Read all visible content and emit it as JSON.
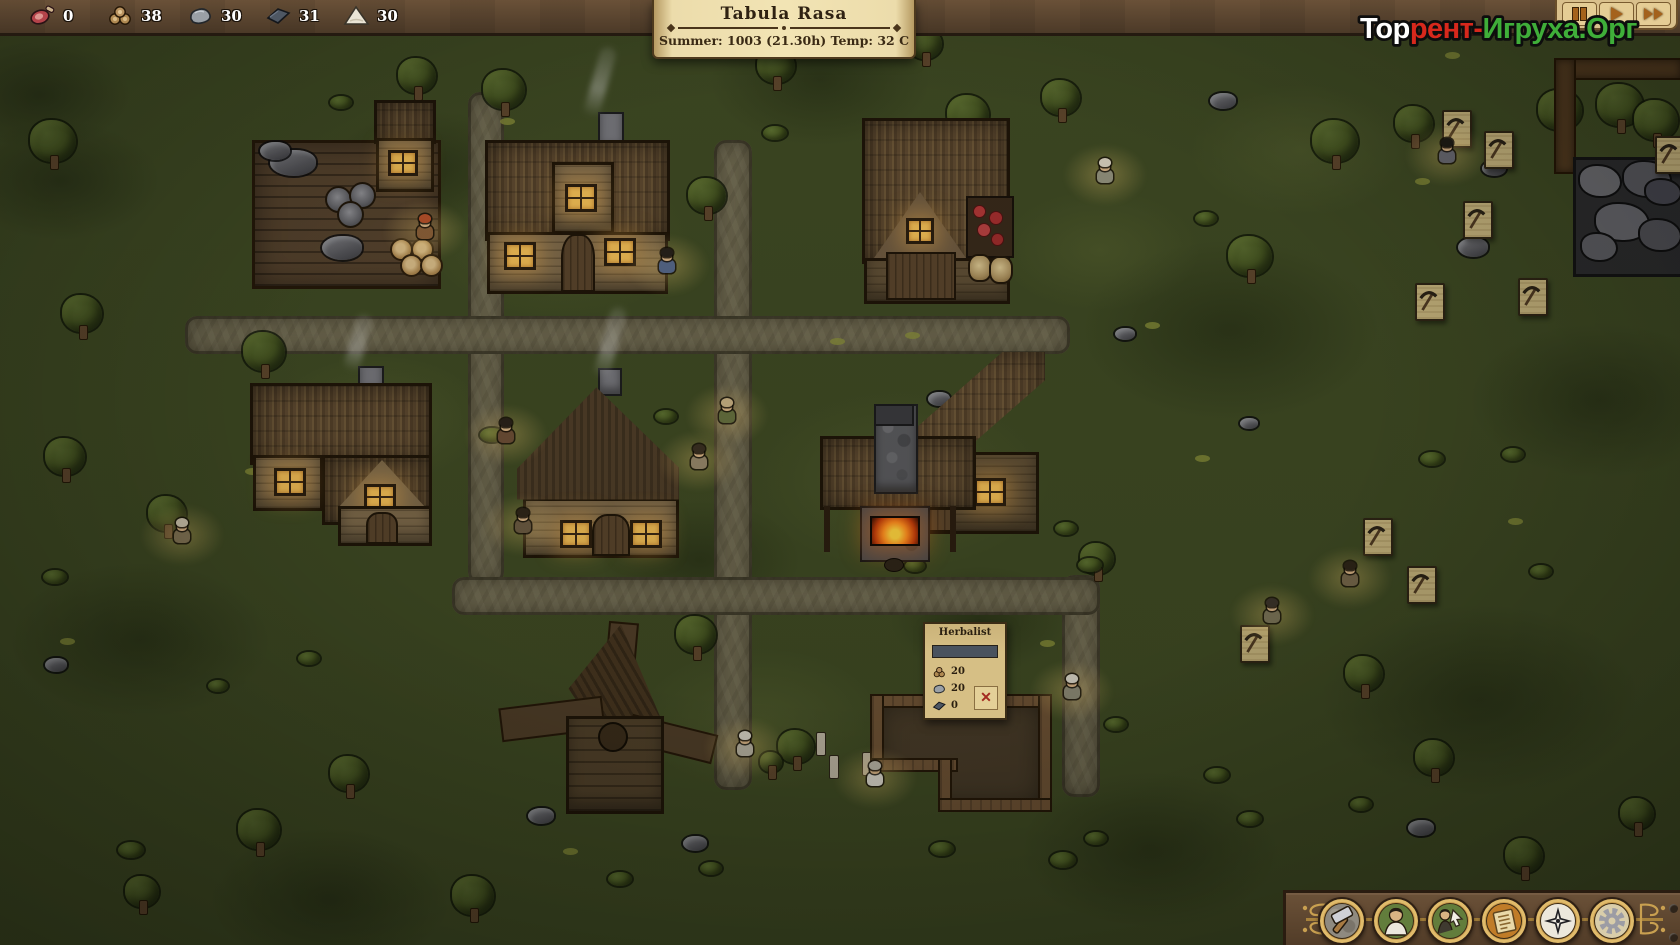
{
  "hud": {
    "topbar_resources": [
      {
        "icon": "ham-icon",
        "value": "0"
      },
      {
        "icon": "logs-icon",
        "value": "38"
      },
      {
        "icon": "stone-icon",
        "value": "30"
      },
      {
        "icon": "iron-icon",
        "value": "31"
      },
      {
        "icon": "sand-icon",
        "value": "30"
      }
    ],
    "banner": {
      "title": "Tabula Rasa",
      "subtitle": "Summer: 1003  (21.30h)  Temp: 32 C"
    },
    "time_controls": [
      "pause",
      "play",
      "fast-forward"
    ],
    "watermark": {
      "segments": [
        {
          "text": "Тор",
          "color": "#ffffff"
        },
        {
          "text": "рент-",
          "color": "#d7281c"
        },
        {
          "text": "Игруха.Орг",
          "color": "#3fae39"
        }
      ]
    }
  },
  "construction_panel": {
    "title": "Herbalist",
    "progress_color": "#49525e",
    "requirements": [
      {
        "icon": "logs-icon",
        "value": "20"
      },
      {
        "icon": "stone-icon",
        "value": "20"
      },
      {
        "icon": "iron-icon",
        "value": "0"
      }
    ],
    "cancel_glyph": "✕"
  },
  "toolbar": {
    "buttons": [
      {
        "name": "build",
        "icon": "hammer-icon"
      },
      {
        "name": "villagers",
        "icon": "villager-icon"
      },
      {
        "name": "professions",
        "icon": "villager-arrow-icon"
      },
      {
        "name": "journal",
        "icon": "scroll-icon"
      },
      {
        "name": "navigate",
        "icon": "compass-icon"
      },
      {
        "name": "settings",
        "icon": "gear-icon"
      }
    ]
  },
  "scene": {
    "patches": [
      [
        140,
        640,
        260,
        0
      ],
      [
        430,
        170,
        200,
        0
      ],
      [
        1230,
        330,
        300,
        0
      ],
      [
        820,
        80,
        220,
        0
      ],
      [
        1480,
        700,
        320,
        0
      ],
      [
        330,
        900,
        240,
        0
      ],
      [
        1600,
        400,
        260,
        0
      ],
      [
        700,
        560,
        200,
        0
      ],
      [
        60,
        180,
        200,
        0
      ],
      [
        1150,
        850,
        260,
        0
      ],
      [
        40,
        95,
        180,
        0
      ],
      [
        980,
        620,
        180,
        0
      ],
      [
        560,
        240,
        260,
        1
      ],
      [
        900,
        480,
        300,
        1
      ],
      [
        380,
        420,
        220,
        1
      ],
      [
        1300,
        150,
        220,
        1
      ],
      [
        760,
        720,
        240,
        1
      ],
      [
        1100,
        250,
        200,
        1
      ]
    ],
    "tufts": [
      [
        500,
        118
      ],
      [
        245,
        468
      ],
      [
        1445,
        52
      ],
      [
        60,
        638
      ],
      [
        348,
        462
      ],
      [
        1145,
        322
      ],
      [
        830,
        338
      ],
      [
        1415,
        178
      ],
      [
        258,
        208
      ],
      [
        1040,
        640
      ],
      [
        563,
        848
      ],
      [
        1195,
        455
      ],
      [
        905,
        332
      ],
      [
        1508,
        518
      ]
    ],
    "rocks": [
      [
        1210,
        93,
        26
      ],
      [
        1482,
        161,
        24
      ],
      [
        1458,
        238,
        30
      ],
      [
        528,
        808,
        26
      ],
      [
        683,
        836,
        24
      ],
      [
        1408,
        820,
        26
      ],
      [
        928,
        392,
        22
      ],
      [
        1115,
        328,
        20
      ],
      [
        1240,
        418,
        18
      ],
      [
        296,
        478,
        20
      ],
      [
        45,
        658,
        22
      ]
    ],
    "trees": [
      [
        30,
        120,
        46
      ],
      [
        62,
        295,
        40
      ],
      [
        243,
        332,
        42
      ],
      [
        398,
        58,
        38
      ],
      [
        483,
        70,
        42
      ],
      [
        757,
        48,
        38
      ],
      [
        688,
        178,
        38
      ],
      [
        908,
        28,
        34
      ],
      [
        947,
        95,
        42
      ],
      [
        1042,
        80,
        38
      ],
      [
        1228,
        236,
        44
      ],
      [
        1312,
        120,
        46
      ],
      [
        1395,
        106,
        38
      ],
      [
        1538,
        90,
        44
      ],
      [
        1597,
        84,
        46
      ],
      [
        1634,
        100,
        44
      ],
      [
        45,
        438,
        40
      ],
      [
        148,
        496,
        38
      ],
      [
        238,
        810,
        42
      ],
      [
        330,
        756,
        38
      ],
      [
        452,
        876,
        42
      ],
      [
        676,
        616,
        40
      ],
      [
        778,
        730,
        36
      ],
      [
        1080,
        543,
        34
      ],
      [
        1345,
        656,
        38
      ],
      [
        1415,
        740,
        38
      ],
      [
        1505,
        838,
        38
      ],
      [
        1620,
        798,
        34
      ],
      [
        125,
        876,
        34
      ],
      [
        760,
        752,
        22
      ]
    ],
    "bushes": [
      [
        763,
        126,
        24
      ],
      [
        525,
        492,
        26
      ],
      [
        480,
        428,
        24
      ],
      [
        655,
        410,
        22
      ],
      [
        43,
        570,
        24
      ],
      [
        118,
        842,
        26
      ],
      [
        1055,
        522,
        22
      ],
      [
        1078,
        558,
        24
      ],
      [
        930,
        842,
        24
      ],
      [
        1050,
        852,
        26
      ],
      [
        1085,
        832,
        22
      ],
      [
        1195,
        212,
        22
      ],
      [
        1420,
        452,
        24
      ],
      [
        1502,
        448,
        22
      ],
      [
        1238,
        812,
        24
      ],
      [
        1350,
        798,
        22
      ],
      [
        1105,
        718,
        22
      ],
      [
        1205,
        768,
        24
      ],
      [
        298,
        652,
        22
      ],
      [
        208,
        680,
        20
      ],
      [
        608,
        872,
        24
      ],
      [
        700,
        862,
        22
      ],
      [
        972,
        392,
        20
      ],
      [
        1530,
        565,
        22
      ],
      [
        330,
        96,
        22
      ],
      [
        905,
        560,
        20
      ]
    ],
    "markers": [
      [
        1442,
        110
      ],
      [
        1484,
        131
      ],
      [
        1463,
        201
      ],
      [
        1415,
        283
      ],
      [
        1518,
        278
      ],
      [
        1363,
        518
      ],
      [
        1407,
        566
      ],
      [
        1240,
        625
      ],
      [
        1655,
        136
      ]
    ],
    "villagers": [
      [
        416,
        214,
        "#8a5f38",
        "#b5502a"
      ],
      [
        658,
        248,
        "#56678a",
        "#26201a"
      ],
      [
        497,
        418,
        "#6d4e36",
        "#2a211a"
      ],
      [
        718,
        398,
        "#66703f",
        "#c9b184"
      ],
      [
        690,
        444,
        "#97876a",
        "#3a2f22"
      ],
      [
        514,
        508,
        "#6b5a42",
        "#2f2519"
      ],
      [
        173,
        518,
        "#837455",
        "#cfc4ae"
      ],
      [
        1096,
        158,
        "#93927e",
        "#d9d0c0"
      ],
      [
        1438,
        138,
        "#6a6a72",
        "#1f1b16"
      ],
      [
        1263,
        598,
        "#7b7458",
        "#3c332a"
      ],
      [
        1341,
        561,
        "#77684c",
        "#2e2418"
      ],
      [
        1063,
        674,
        "#8d8a76",
        "#d8d3c6"
      ],
      [
        736,
        731,
        "#b8b2a2",
        "#d8d3c6"
      ],
      [
        866,
        761,
        "#d9d5ca",
        "#b9b4a6"
      ]
    ],
    "smoke": [
      [
        592,
        46,
        72
      ],
      [
        350,
        314,
        58
      ],
      [
        602,
        306,
        74
      ]
    ],
    "planks": [
      [
        816,
        732
      ],
      [
        829,
        755
      ],
      [
        862,
        752
      ]
    ]
  }
}
